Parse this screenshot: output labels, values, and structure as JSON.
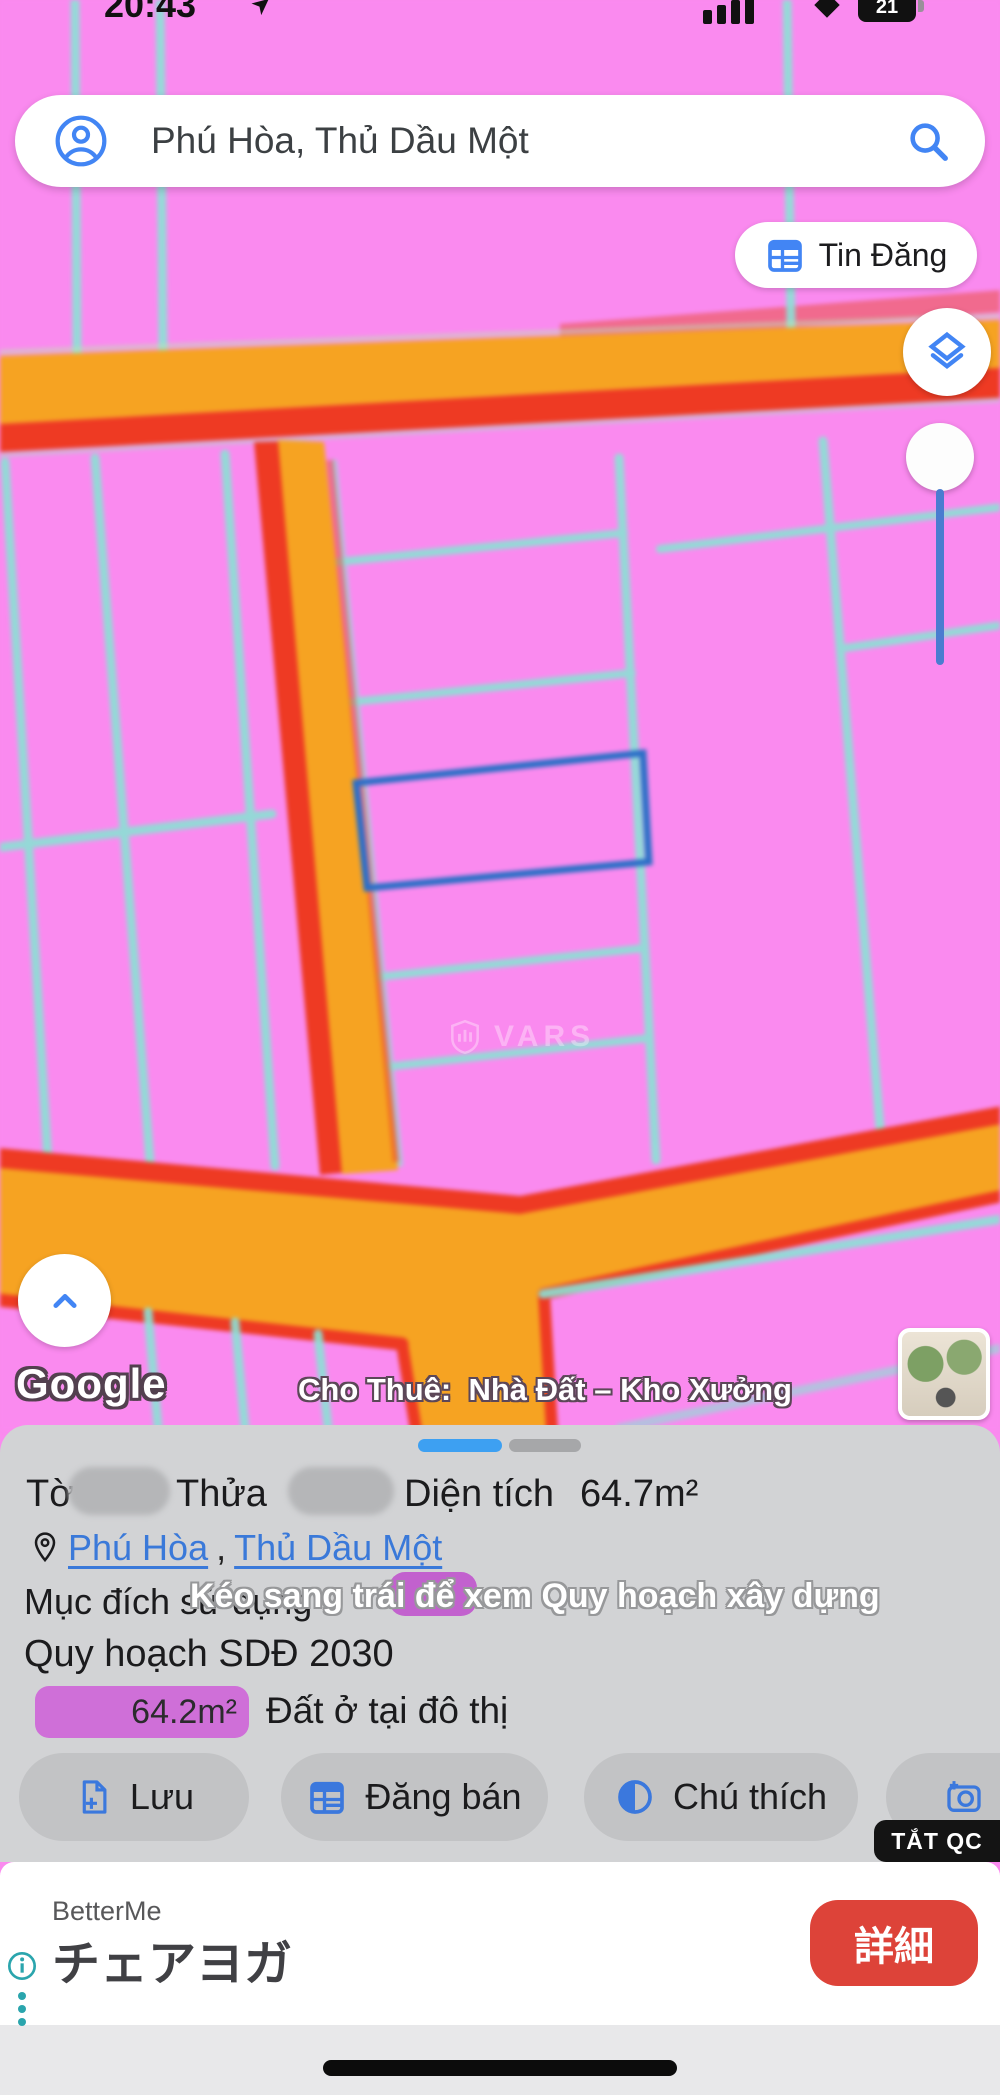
{
  "status_bar": {
    "time": "20:43",
    "battery_level": "21"
  },
  "map": {
    "search_query": "Phú Hòa, Thủ Dầu Một",
    "tin_dang_button": "Tin Đăng",
    "google_watermark": "Google",
    "listing_label": "Cho Thuê:  Nhà Đất – Kho Xưởng",
    "vars_watermark": "VARS",
    "colors": {
      "parcel_pink": "#fa8aef",
      "boundary_cyan": "#8be1d5",
      "road_orange": "#f6a322",
      "road_red": "#ee3a23",
      "selected_parcel_blue": "#2c6fc7",
      "accent_blue": "#4285f4"
    }
  },
  "panel": {
    "title": {
      "to_label": "Tờ",
      "thua_label": "Thửa",
      "area_label": "Diện tích",
      "area_value": "64.7m²"
    },
    "location": {
      "ward": "Phú Hòa",
      "separator": ",",
      "city": "Thủ Dầu Một"
    },
    "purpose_label": "Mục đích sử dụng",
    "swipe_hint": "Kéo sang trái để xem Quy hoạch xây dựng",
    "plan_label": "Quy hoạch SDĐ 2030",
    "zone": {
      "area": "64.2m²",
      "land_type": "Đất ở tại đô thị",
      "badge_color": "#cf6fd8"
    },
    "buttons": [
      {
        "label": "Lưu",
        "icon": "document-plus-icon"
      },
      {
        "label": "Đăng bán",
        "icon": "listing-grid-icon"
      },
      {
        "label": "Chú thích",
        "icon": "legend-icon"
      },
      {
        "label": "C",
        "icon": "camera-plus-icon"
      }
    ]
  },
  "ad": {
    "dismiss_label": "TẮT QC",
    "brand": "BetterMe",
    "title": "チェアヨガ",
    "cta_label": "詳細",
    "cta_color": "#dd4339",
    "accent_teal": "#2aa5ad"
  }
}
